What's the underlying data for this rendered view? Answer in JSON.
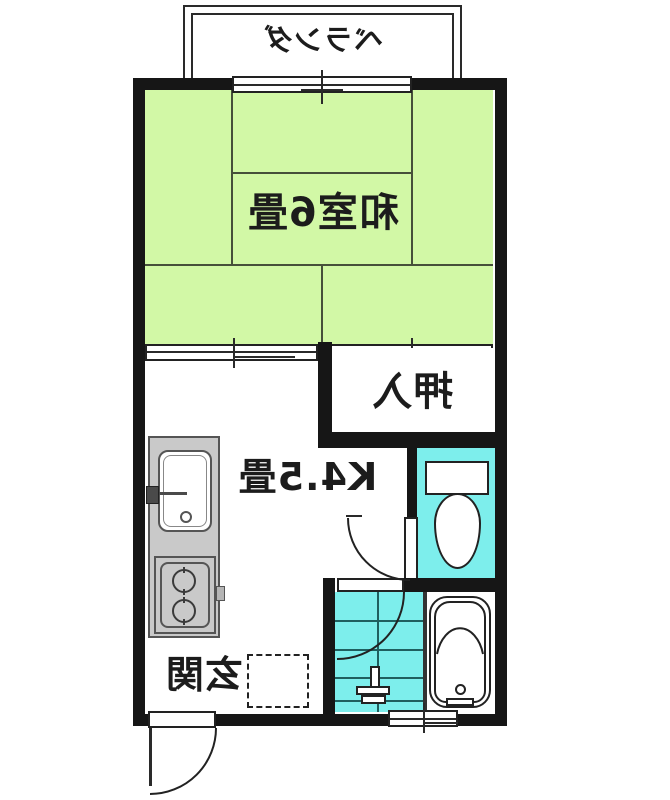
{
  "plan": {
    "type": "japanese-apartment-floor-plan",
    "presentation": {
      "text_mirrored": true
    },
    "balcony": {
      "label": "ベランダ"
    },
    "washitsu": {
      "label": "和室6畳"
    },
    "closet": {
      "label": "押入"
    },
    "kitchen": {
      "label": "K4.5畳"
    },
    "entrance": {
      "label": "玄関"
    },
    "fixtures": [
      "kitchen-sink",
      "two-burner-stove",
      "toilet",
      "bathtub",
      "washroom-tap",
      "entrance-door",
      "toilet-door",
      "washroom-door",
      "sliding-doors",
      "windows",
      "entrance-step"
    ],
    "colors": {
      "wall": "#161616",
      "tatami_green": "#d2f8a6",
      "water_cyan": "#7deeec",
      "counter_gray": "#c9c9c9",
      "line_dark": "#46503a",
      "text": "#1c1c1c"
    }
  }
}
